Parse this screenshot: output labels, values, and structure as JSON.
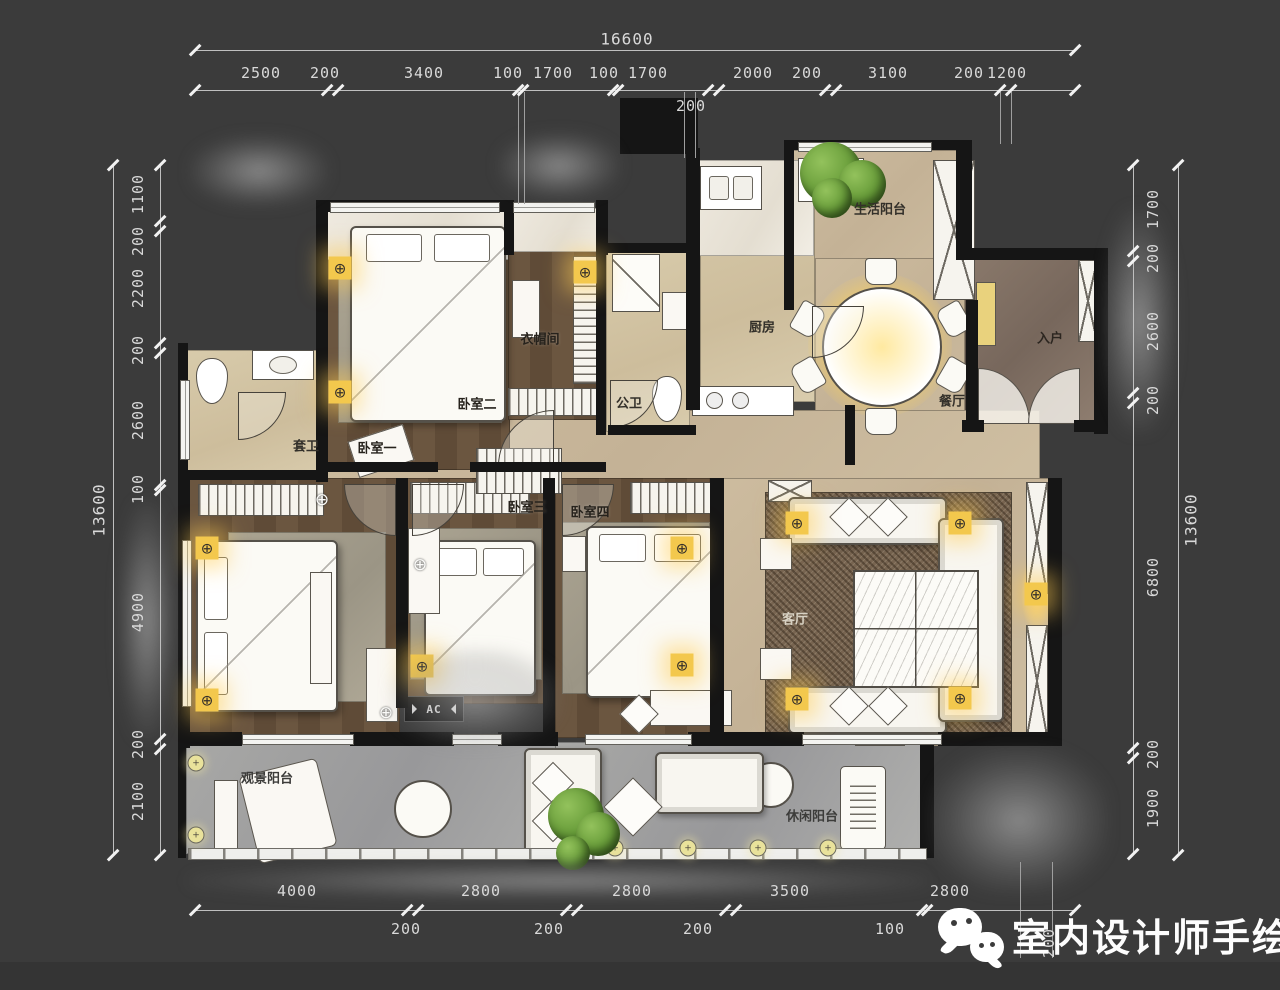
{
  "watermark": {
    "brand": "室内设计师手绘",
    "icon": "wechat-icon"
  },
  "dims": {
    "top": {
      "total": "16600",
      "segments": [
        "2500",
        "200",
        "3400",
        "100",
        "1700",
        "100",
        "1700",
        "2000",
        "200",
        "3100",
        "200",
        "1200"
      ],
      "below": "200"
    },
    "left": {
      "total": "13600",
      "segments": [
        "1100",
        "200",
        "2200",
        "200",
        "2600",
        "100",
        "4900",
        "200",
        "2100"
      ]
    },
    "right": {
      "total": "13600",
      "segments": [
        "1700",
        "200",
        "2600",
        "200",
        "6800",
        "200",
        "1900"
      ]
    },
    "bottom": {
      "segments": [
        "4000",
        "2800",
        "2800",
        "3500",
        "2800"
      ],
      "below": [
        "200",
        "200",
        "200",
        "100",
        "200"
      ]
    }
  },
  "rooms": {
    "living_balcony": "生活阳台",
    "kitchen": "厨房",
    "dining": "餐厅",
    "entry": "入户",
    "cloakroom": "衣帽间",
    "public_bath": "公卫",
    "ensuite_bath": "套卫",
    "bedroom1": "卧室一",
    "bedroom2": "卧室二",
    "bedroom3": "卧室三",
    "bedroom4": "卧室四",
    "living_room": "客厅",
    "view_balcony": "观景阳台",
    "leisure_balcony": "休闲阳台",
    "ac_platform": "AC"
  },
  "icons": {
    "ceiling_light": "⊕",
    "balcony_light": "+"
  },
  "colors": {
    "background": "#3b3b3b",
    "dimension_text": "#d9d9d9",
    "wall": "#151515",
    "floor_beige": "#c9b89c",
    "floor_wood": "#64503c",
    "floor_gray": "#a3a3a3",
    "floor_entry": "#7c6c5f",
    "accent_light": "#f3c84d",
    "plant_green": "#679b3f"
  }
}
